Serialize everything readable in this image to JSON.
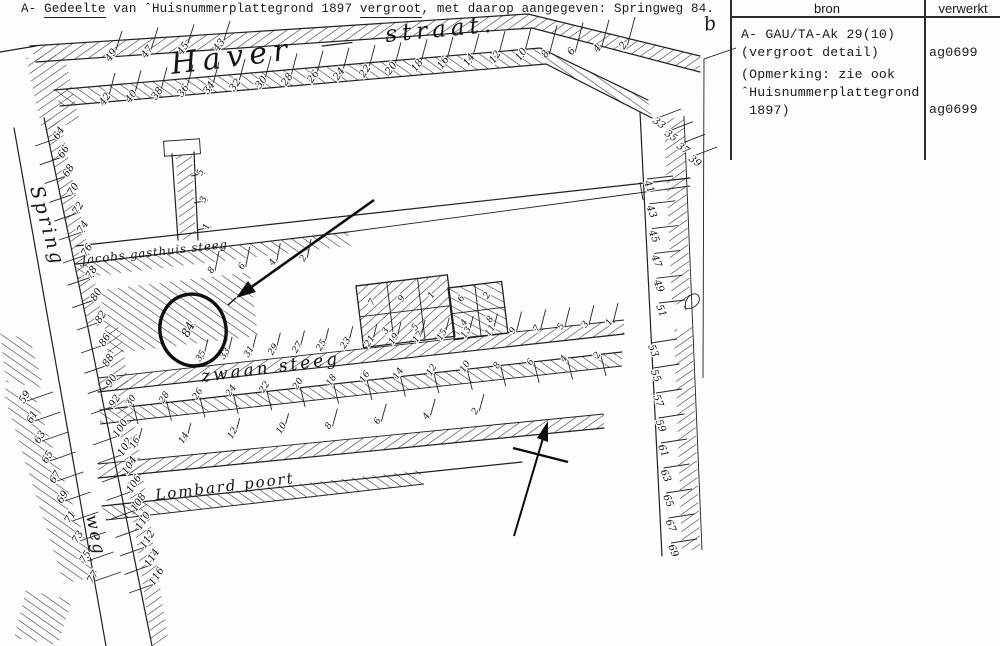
{
  "caption": {
    "prefix": "A- ",
    "underline1": "Gedeelte",
    "middle": " van ˆHuisnummerplattegrond 1897 ",
    "underline2": "vergroot",
    "suffix": ", met daarop aangegeven: Springweg 84."
  },
  "margin_note": {
    "letter": "b"
  },
  "table": {
    "header": {
      "bron": "bron",
      "verwerkt": "verwerkt"
    },
    "row1": {
      "line1": "A- GAU/TA-Ak 29(10)",
      "line2": "(vergroot detail)",
      "verwerkt": "ag0699"
    },
    "row2": {
      "line1": "(Opmerking: zie ook",
      "line2": "ˆHuisnummerplattegrond",
      "line3": " 1897)",
      "verwerkt": "ag0699"
    }
  },
  "map": {
    "labels": {
      "haver": "Haver",
      "straat": "straat.",
      "spring": "Spring",
      "weg": "weg",
      "jacobs": "Jacobs gasthuis steeg",
      "zwaan": "zwaan steeg",
      "lombard": "Lombard poort"
    },
    "marker": {
      "number": "84"
    },
    "number_groups": {
      "haver_north": [
        "49",
        "47",
        "45",
        "43"
      ],
      "haver_south": [
        "42",
        "40",
        "38",
        "36",
        "34",
        "32",
        "30",
        "28",
        "26",
        "24",
        "22",
        "20",
        "18",
        "16",
        "14",
        "12",
        "10",
        "8",
        "6",
        "4",
        "2"
      ],
      "right_bend": [
        "33",
        "35",
        "37",
        "39"
      ],
      "right_upper": [
        "41",
        "43",
        "45",
        "47",
        "49",
        "51"
      ],
      "right_lower": [
        "53",
        "55",
        "57",
        "59",
        "61",
        "63",
        "65",
        "67",
        "69"
      ],
      "spring_upper": [
        "64",
        "66",
        "68",
        "70",
        "72",
        "74"
      ],
      "spring_mid": [
        "76",
        "78",
        "80",
        "82"
      ],
      "spring_low": [
        "86",
        "88",
        "90",
        "92"
      ],
      "spring_bottom": [
        "100",
        "102",
        "104",
        "106",
        "108",
        "110",
        "112",
        "114",
        "116"
      ],
      "spring_west": [
        "59",
        "61",
        "63",
        "65",
        "67",
        "69",
        "71",
        "73",
        "75",
        "77"
      ],
      "jacobs_south": [
        "8",
        "6",
        "4",
        "2"
      ],
      "stub": [
        "5",
        "3",
        "1"
      ],
      "zwaan_north": [
        "35",
        "33",
        "31",
        "29",
        "27",
        "25",
        "23",
        "21",
        "19",
        "17",
        "15",
        "13",
        "11",
        "9",
        "7",
        "5",
        "3",
        "1"
      ],
      "zwaan_south": [
        "30",
        "28",
        "26",
        "24",
        "22",
        "20",
        "18",
        "16",
        "14",
        "12",
        "10",
        "8",
        "6",
        "4",
        "2"
      ],
      "lombard_north": [
        "16",
        "14",
        "12",
        "10",
        "8",
        "6",
        "4",
        "2"
      ]
    },
    "court_numbers": {
      "left": [
        "7",
        "9",
        "1",
        "3",
        "5"
      ],
      "right": [
        "6",
        "2",
        "4",
        "8"
      ]
    }
  }
}
